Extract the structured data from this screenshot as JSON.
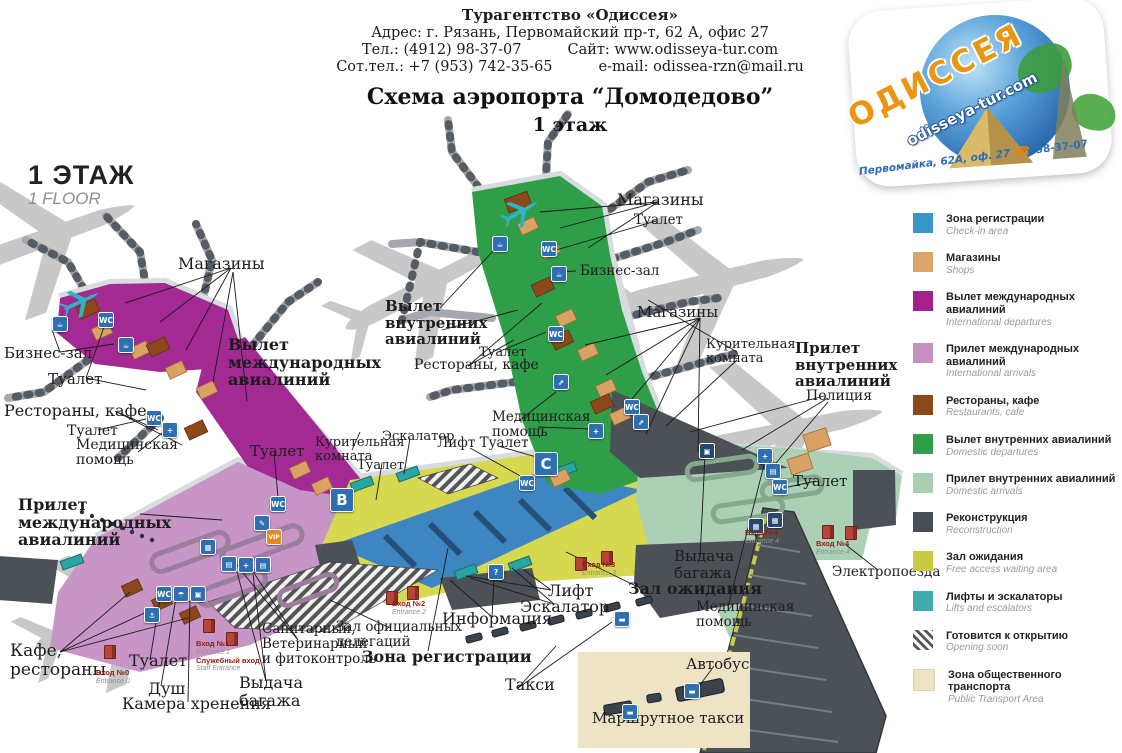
{
  "header": {
    "agency": "Турагентство «Одиссея»",
    "address": "Адрес: г. Рязань, Первомайский пр-т, 62 А, офис 27",
    "phone": "Тел.: (4912) 98-37-07",
    "site": "Сайт: www.odisseya-tur.com",
    "mobile": "Сот.тел.: +7 (953) 742-35-65",
    "email": "e-mail: odissea-rzn@mail.ru",
    "title": "Схема аэропорта “Домодедово”",
    "subtitle": "1 этаж"
  },
  "logo": {
    "name": "ОДИССЕЯ",
    "site": "odisseya-tur.com",
    "address": "Первомайка, 62А, оф. 27",
    "phone": "98-37-07",
    "phone_icon": "☎"
  },
  "floor": {
    "ru": "1 ЭТАЖ",
    "en": "1 FLOOR"
  },
  "icons": {
    "toilet": "WC",
    "medical": "+",
    "info": "?",
    "lounge": "☕",
    "escalator": "⇗",
    "vip": "VIP",
    "pen": "✎",
    "shower": "☂",
    "locker": "▣",
    "anchor": "⚓",
    "passport": "▤",
    "screen": "▦",
    "vehicle": "▬",
    "zone_b": "B",
    "zone_c": "C"
  },
  "map": {
    "labels": {
      "shops_intl": "Магазины",
      "business_intl": "Бизнес-зал",
      "toilet_intl_1": "Туалет",
      "intl_departures": "Вылет\nмеждународных\nавиалиний",
      "restaurants_intl": "Рестораны, кафе",
      "toilet_intl_2": "Туалет",
      "med_intl": "Медицинская\nпомощь",
      "toilet_intl_3": "Туалет",
      "intl_arrivals": "Прилет\nмеждународных\nавиалиний",
      "cafe_restaurants": "Кафе,\nрестораны",
      "toilet_arr": "Туалет",
      "shower": "Душ",
      "luggage_room": "Камера хренения",
      "baggage_claim_left": "Выдача\nбагажа",
      "sanitary": "Санитарный,\nВетеринарный\nи фитоконтроль",
      "delegations": "Зал официальных\nделегаций",
      "checkin_zone": "Зона регистрации",
      "information": "Информация",
      "escalator_bottom": "Эскалатор",
      "lift_bottom": "Лифт",
      "taxi": "Такси",
      "waiting_hall": "Зал ожидания",
      "baggage_claim_right": "Выдача\nбагажа",
      "med_right": "Медицинская\nпомощь",
      "bus": "Автобус",
      "marshrutka": "Маршрутное такси",
      "trains": "Электропоезда",
      "toilet_dom_arr": "Туалет",
      "police": "Полиция",
      "dom_arrivals": "Прилет\nвнутренних\nавиалиний",
      "smoking_right": "Курительная\nкомната",
      "shops_dom_right": "Магазины",
      "restaurants_dom": "Рестораны, кафе",
      "toilet_dom_1": "Туалет",
      "dom_departures": "Вылет\nвнутренних\nавиалиний",
      "shops_dom_top": "Магазины",
      "toilet_dom_top": "Туалет",
      "business_dom": "Бизнес-зал",
      "med_center": "Медицинская\nпомощь",
      "lift_toilet": "Лифт Туалет",
      "smoking_center": "Курительная\nкомната",
      "escalator_center": "Эскалатор",
      "toilet_center": "Туалет"
    },
    "entrances": {
      "e0": {
        "ru": "Вход №0",
        "en": "Entrance 0"
      },
      "e1": {
        "ru": "Вход №1",
        "en": "Entrance 1"
      },
      "staff": {
        "ru": "Служебный вход",
        "en": "Staff Entrance"
      },
      "e2": {
        "ru": "Вход №2",
        "en": "Entrance 2"
      },
      "e3": {
        "ru": "Вход №3",
        "en": "Entrance 3"
      },
      "e4": {
        "ru": "Вход №4",
        "en": "Entrance 4"
      }
    }
  },
  "legend": {
    "items": [
      {
        "id": "checkin",
        "color": "#3a96c8",
        "ru": "Зона регистрации",
        "en": "Check-in area"
      },
      {
        "id": "shops",
        "color": "#dca468",
        "ru": "Магазины",
        "en": "Shops"
      },
      {
        "id": "intl-dep",
        "color": "#a2218e",
        "ru": "Вылет международных авиалиний",
        "en": "International departures"
      },
      {
        "id": "intl-arr",
        "color": "#c591c4",
        "ru": "Прилет международных авиалиний",
        "en": "International arrivals"
      },
      {
        "id": "restaurants",
        "color": "#8a481b",
        "ru": "Рестораны, кафе",
        "en": "Restaurants, cafe"
      },
      {
        "id": "dom-dep",
        "color": "#2f9e48",
        "ru": "Вылет внутренних авиалиний",
        "en": "Domestic departures"
      },
      {
        "id": "dom-arr",
        "color": "#a9cfb2",
        "ru": "Прилет внутренних авиалиний",
        "en": "Domestic arrivals"
      },
      {
        "id": "reconstruction",
        "color": "#474f55",
        "ru": "Реконструкция",
        "en": "Reconstruction"
      },
      {
        "id": "waiting",
        "color": "#c8cb3f",
        "ru": "Зал ожидания",
        "en": "Free access waiting area"
      },
      {
        "id": "lifts",
        "color": "#3fadab",
        "ru": "Лифты и эскалаторы",
        "en": "Lifts and escalators"
      },
      {
        "id": "opening-soon",
        "color": "#ffffff",
        "ru": "Готовится к открытию",
        "en": "Opening soon",
        "hatched": true
      },
      {
        "id": "transport",
        "color": "#ece4c3",
        "ru": "Зона общественного транспорта",
        "en": "Public Transport Area"
      }
    ]
  },
  "palette": {
    "intl_departures": "#a32a93",
    "intl_arrivals": "#c795c6",
    "dom_departures": "#2f9e48",
    "dom_arrivals": "#abd0b5",
    "waiting": "#d6d84f",
    "checkin": "#3e86c2",
    "reconstruction": "#4b5157",
    "transport": "#ede4c6",
    "shops": "#d9a163",
    "restaurants": "#8a481b",
    "lifts": "#2aa5a2",
    "icon_blue": "#2e6fb2",
    "entrance_red": "#b8453a"
  }
}
